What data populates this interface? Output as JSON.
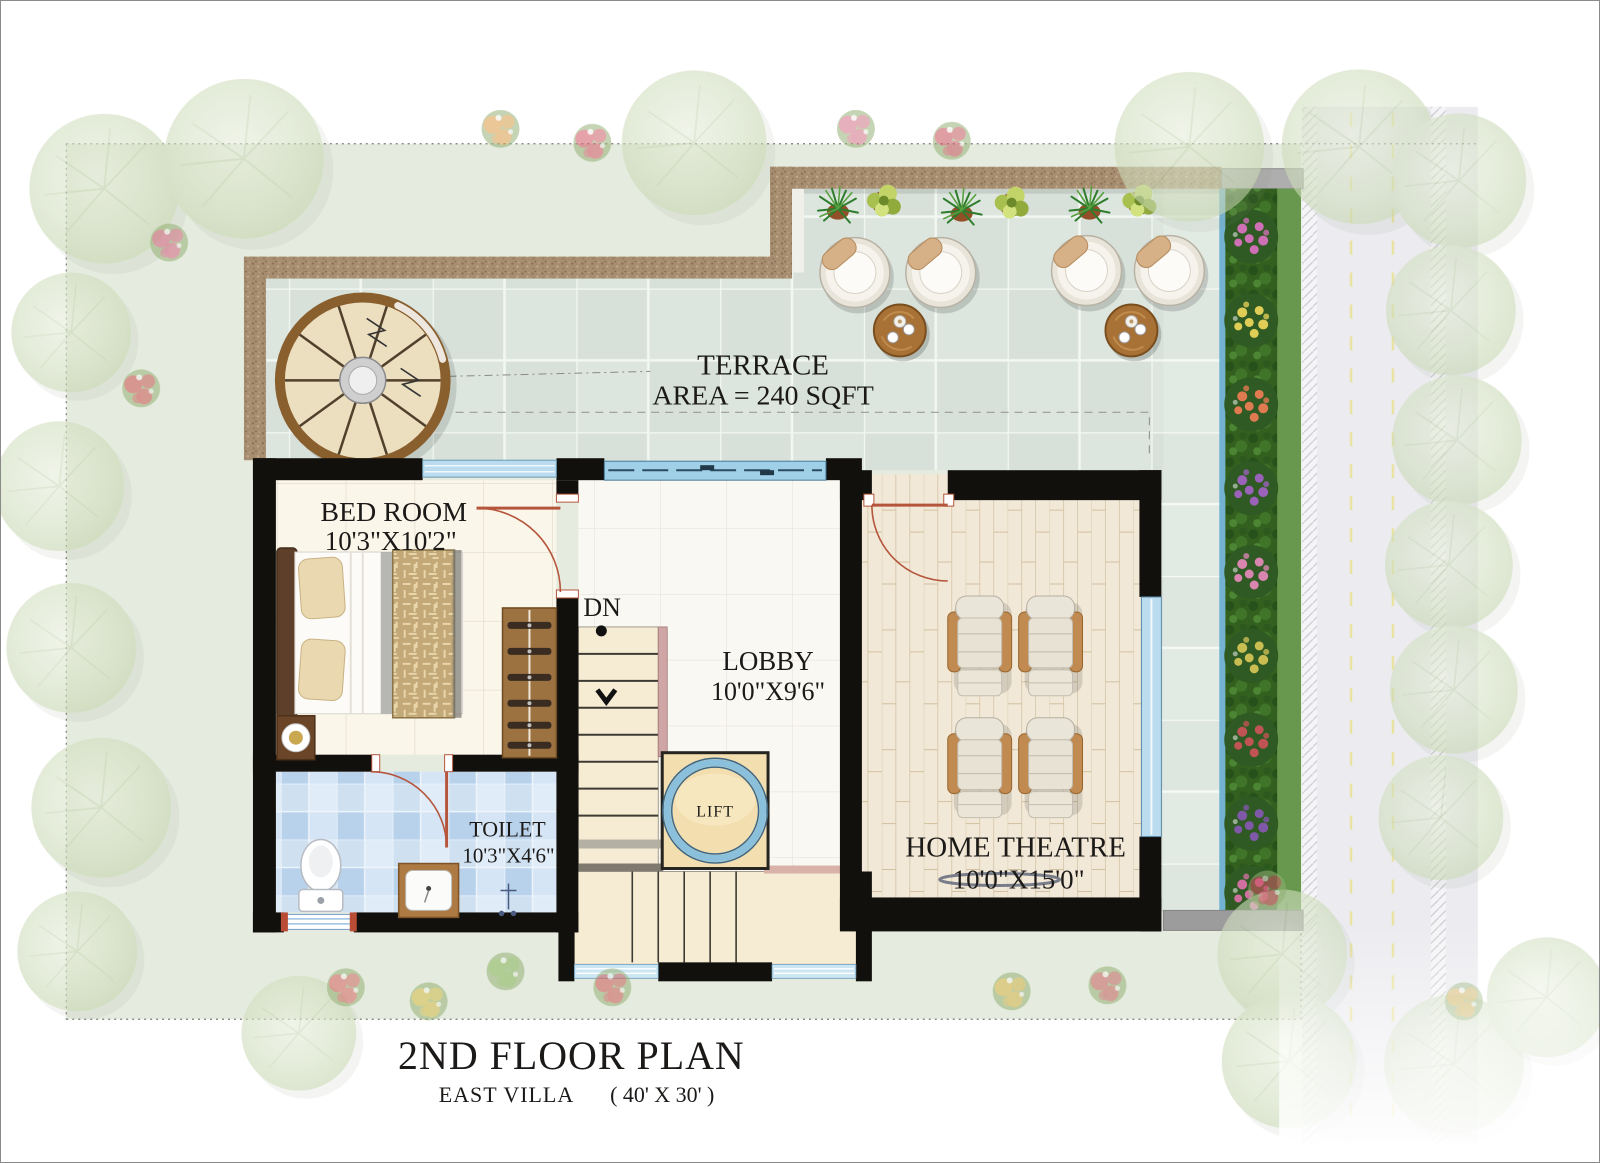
{
  "palette": {
    "ink": "#1c1a18",
    "wall": "#12100d",
    "door": "#b5563c",
    "window_glass": "#a9d3ea",
    "terrace_tile": "#dce6df",
    "parapet": "#a88e70",
    "lawn_site": "#e5ecdf",
    "lawn_strip": "#67984e",
    "wood_floor": "#f1e8d7",
    "toilet_tile": "#c5daf0",
    "stair_tread": "#f6ecd4",
    "lift_marble": "#f3deb0",
    "road": "#eaeaee",
    "lane_dash": "#e6df96",
    "pool_edge_blue": "#5fa8d0"
  },
  "rooms": {
    "terrace": {
      "name": "TERRACE",
      "area_line": "AREA = 240 SQFT"
    },
    "bedroom": {
      "name": "BED ROOM",
      "dims": "10'3\"X10'2\""
    },
    "lobby": {
      "name": "LOBBY",
      "dims": "10'0\"X9'6\""
    },
    "toilet": {
      "name": "TOILET",
      "dims": "10'3\"X4'6\""
    },
    "home_theatre": {
      "name": "HOME THEATRE",
      "dims": "10'0\"X15'0\""
    },
    "lift": {
      "name": "LIFT"
    },
    "stairs": {
      "down_label": "DN"
    }
  },
  "title": {
    "main": "2ND FLOOR PLAN",
    "villa": "EAST VILLA",
    "size": "( 40' X 30' )"
  }
}
